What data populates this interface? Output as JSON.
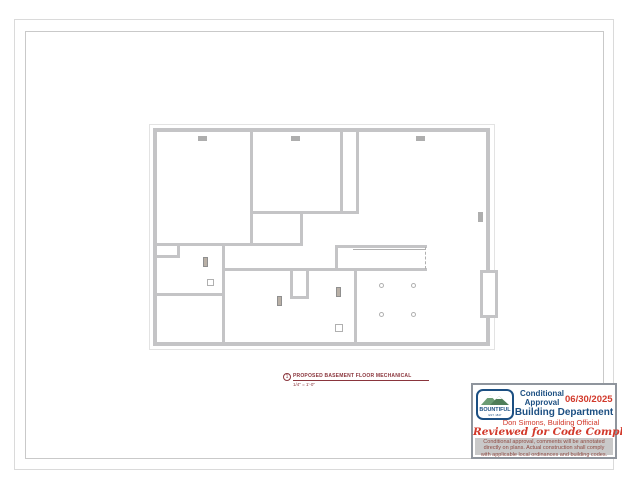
{
  "colors": {
    "wall": "#c4c4c6",
    "wall_light": "#e3e3e3",
    "register": "#aeaeae",
    "fixture_fill": "#b9b0a6",
    "fixture_border": "#8f8f8f",
    "line": "#b0b0b0",
    "border_outer": "#dadada",
    "border_inner": "#c9c9c9",
    "callout": "#8a353c",
    "stamp_blue": "#1c4f82",
    "stamp_red": "#d2392b",
    "stamp_maroon": "#8e4a42",
    "stamp_gray": "#c9c9c9",
    "logo_green_back": "#6b9c74",
    "logo_green_front": "#4e7d58"
  },
  "title_callout": {
    "number": "1",
    "title": "PROPOSED BASEMENT FLOOR MECHANICAL",
    "scale": "1/4\" = 1'-0\""
  },
  "stamp": {
    "logo_name": "BOUNTIFUL",
    "logo_est": "EST. 1847",
    "status_line1": "Conditional",
    "status_line2": "Approval",
    "date": "06/30/2025",
    "department": "Building Department",
    "official": "Don Simons, Building Official",
    "reviewed": "Reviewed for Code Compliance",
    "disclaimer": "Conditional approval, comments will be annotated directly on plans. Actual construction shall comply with applicable local ordinances and building codes."
  },
  "plan": {
    "outline": {
      "x": 149,
      "y": 124,
      "w": 346,
      "h": 226
    },
    "walls": [
      {
        "x": 153,
        "y": 128,
        "w": 337,
        "h": 4
      },
      {
        "x": 153,
        "y": 342,
        "w": 337,
        "h": 4
      },
      {
        "x": 153,
        "y": 128,
        "w": 4,
        "h": 218
      },
      {
        "x": 486,
        "y": 128,
        "w": 4,
        "h": 218
      },
      {
        "x": 250,
        "y": 130,
        "w": 3,
        "h": 115
      },
      {
        "x": 250,
        "y": 211,
        "w": 109,
        "h": 3
      },
      {
        "x": 340,
        "y": 130,
        "w": 3,
        "h": 83
      },
      {
        "x": 356,
        "y": 130,
        "w": 3,
        "h": 83
      },
      {
        "x": 300,
        "y": 213,
        "w": 3,
        "h": 32
      },
      {
        "x": 155,
        "y": 243,
        "w": 148,
        "h": 3
      },
      {
        "x": 155,
        "y": 255,
        "w": 25,
        "h": 3
      },
      {
        "x": 177,
        "y": 245,
        "w": 3,
        "h": 12
      },
      {
        "x": 222,
        "y": 245,
        "w": 3,
        "h": 99
      },
      {
        "x": 155,
        "y": 293,
        "w": 69,
        "h": 3
      },
      {
        "x": 222,
        "y": 268,
        "w": 205,
        "h": 3
      },
      {
        "x": 354,
        "y": 270,
        "w": 3,
        "h": 74
      },
      {
        "x": 335,
        "y": 245,
        "w": 92,
        "h": 3
      },
      {
        "x": 335,
        "y": 247,
        "w": 3,
        "h": 23
      },
      {
        "x": 290,
        "y": 270,
        "w": 3,
        "h": 29
      },
      {
        "x": 306,
        "y": 270,
        "w": 3,
        "h": 29
      },
      {
        "x": 290,
        "y": 296,
        "w": 19,
        "h": 3
      }
    ],
    "registers": [
      {
        "x": 198,
        "y": 136,
        "w": 9,
        "h": 5
      },
      {
        "x": 291,
        "y": 136,
        "w": 9,
        "h": 5
      },
      {
        "x": 416,
        "y": 136,
        "w": 9,
        "h": 5
      },
      {
        "x": 478,
        "y": 212,
        "w": 5,
        "h": 10
      }
    ],
    "fixtures": [
      {
        "x": 203,
        "y": 257,
        "w": 5,
        "h": 10
      },
      {
        "x": 277,
        "y": 296,
        "w": 5,
        "h": 10
      },
      {
        "x": 336,
        "y": 287,
        "w": 5,
        "h": 10
      }
    ],
    "drains": [
      {
        "x": 207,
        "y": 279,
        "w": 7,
        "h": 7
      },
      {
        "x": 335,
        "y": 324,
        "w": 8,
        "h": 8
      }
    ],
    "posts": [
      {
        "cx": 381,
        "cy": 285
      },
      {
        "cx": 413,
        "cy": 285
      },
      {
        "cx": 381,
        "cy": 314
      },
      {
        "cx": 413,
        "cy": 314
      }
    ],
    "stair": {
      "rail": {
        "x": 353,
        "y": 249,
        "w": 72
      },
      "dashed": {
        "x": 425,
        "y": 247,
        "h": 22
      }
    },
    "window_well": {
      "x": 480,
      "y": 270,
      "w": 18,
      "h": 48
    }
  }
}
